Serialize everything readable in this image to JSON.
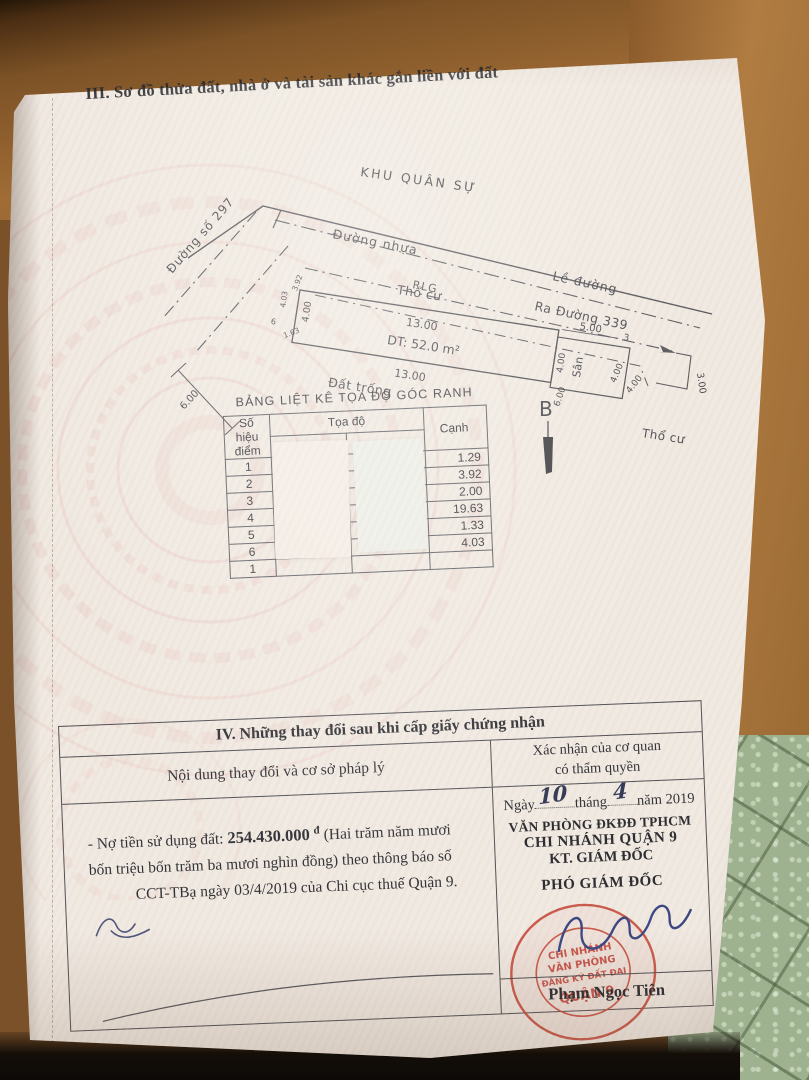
{
  "page": {
    "section3_title": "III. Sơ đồ thửa đất, nhà ở và tài sản khác gắn liền với đất"
  },
  "diagram": {
    "khu_quan_su": "KHU QUÂN SỰ",
    "duong_nhua": "Đường nhựa",
    "le_duong": "Lề đường",
    "ra_duong": "Ra Đường 339",
    "duong_so": "Đường số 297",
    "rlg": "RLG",
    "tho_cu_top": "Thổ cư",
    "tho_cu_right": "Thổ cư",
    "dat_trong": "Đất trống",
    "san": "Sân",
    "dt": "DT: 52.0 m²",
    "north": "B",
    "dim_top": "13.00",
    "dim_bottom": "13.00",
    "dim_left": "4.00",
    "dim_san_top": "5.00",
    "dim_san_left": "4.00",
    "dim_san_right": "4.00",
    "dim_san_right2": "4.00",
    "dim_san_bottom": "6.00",
    "dim_hook": "3.00",
    "dim_front": "6.00",
    "point3": "3",
    "small_dims": {
      "a": "4.03",
      "b": "3.92",
      "c": "1.63",
      "d": "6"
    }
  },
  "coord_table": {
    "title": "BẢNG LIỆT KÊ TỌA ĐỘ GÓC RANH",
    "col_point_1": "Số hiệu",
    "col_point_2": "điểm",
    "col_coord": "Tọa độ",
    "col_edge": "Cạnh",
    "rows": [
      {
        "point": "1",
        "edge": "1.29"
      },
      {
        "point": "2",
        "edge": "3.92"
      },
      {
        "point": "3",
        "edge": "2.00"
      },
      {
        "point": "4",
        "edge": "19.63"
      },
      {
        "point": "5",
        "edge": "1.33"
      },
      {
        "point": "6",
        "edge": "4.03"
      },
      {
        "point": "1",
        "edge": ""
      }
    ]
  },
  "section4": {
    "title": "IV. Những thay đổi sau khi cấp giấy chứng nhận",
    "col_left": "Nội dung thay đổi và cơ sở pháp lý",
    "col_right_1": "Xác nhận của cơ quan",
    "col_right_2": "có thẩm quyền",
    "content": {
      "prefix": "- Nợ tiền sử dụng đất: ",
      "amount": "254.430.000",
      "currency": "đ",
      "body": "(Hai trăm năm mươi bốn triệu bốn trăm ba mươi nghìn đồng) theo thông báo số",
      "body2": "CCT-TBạ ngày 03/4/2019 của Chi cục thuế Quận 9."
    },
    "approval": {
      "date_label1": "Ngày",
      "date_day": "10",
      "date_label2": "tháng",
      "date_month": "4",
      "date_label3": "năm 2019",
      "office1": "VĂN PHÒNG ĐKĐĐ TPHCM",
      "office2": "CHI NHÁNH QUẬN 9",
      "office3": "KT. GIÁM ĐỐC",
      "office4": "PHÓ GIÁM ĐỐC",
      "signer": "Phạm Ngọc Tiên",
      "stamp": {
        "l1": "CHI NHÁNH",
        "l2": "VĂN PHÒNG",
        "l3": "ĐĂNG KÝ ĐẤT ĐAI",
        "l4": "QUẬN 9"
      }
    }
  }
}
